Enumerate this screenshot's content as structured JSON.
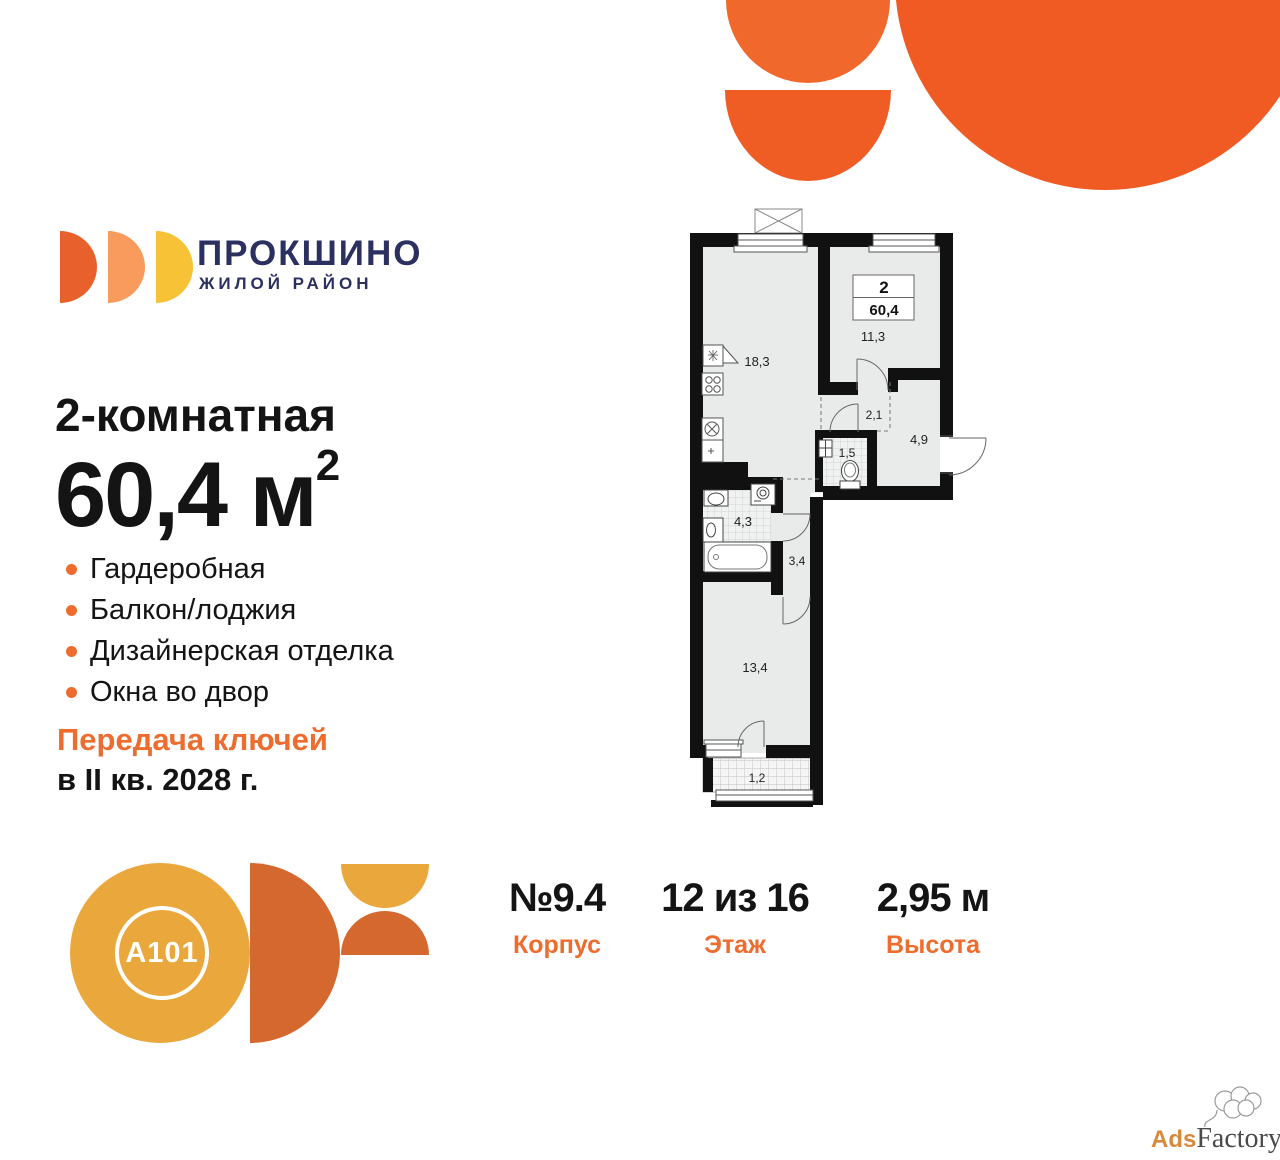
{
  "colors": {
    "accent_orange": "#ED6C2E",
    "brand_navy": "#2B3060",
    "deco_orange_big": "#F05A23",
    "deco_orange_mid": "#EF5D24",
    "deco_orange_light": "#F0682B",
    "logo_half_1": "#E8602C",
    "logo_half_2": "#F89B5C",
    "logo_half_3": "#F8C237",
    "a101_yellow": "#EAA73C",
    "a101_orange": "#D4682F",
    "plan_room_fill": "#E9EBEA",
    "plan_wall": "#111111"
  },
  "brand": {
    "name": "ПРОКШИНО",
    "subtitle": "ЖИЛОЙ РАЙОН"
  },
  "developer": {
    "logo_text": "A101"
  },
  "offer": {
    "title": "2-комнатная",
    "area_value": "60,4",
    "area_unit": " м",
    "area_sup": "2",
    "features": [
      "Гардеробная",
      "Балкон/лоджия",
      "Дизайнерская отделка",
      "Окна во двор"
    ],
    "keys_line1": "Передача ключей",
    "keys_line2": "в II кв. 2028 г."
  },
  "floorplan": {
    "info_box": {
      "rooms": "2",
      "area": "60,4"
    },
    "areas": {
      "kitchen_living": "18,3",
      "bedroom": "11,3",
      "wardrobe": "2,1",
      "hallway": "4,9",
      "wc": "1,5",
      "bathroom": "4,3",
      "corridor": "3,4",
      "bedroom2": "13,4",
      "balcony": "1,2"
    }
  },
  "stats": [
    {
      "value": "№9.4",
      "label": "Корпус"
    },
    {
      "value": "12 из 16",
      "label": "Этаж"
    },
    {
      "value": "2,95 м",
      "label": "Высота"
    }
  ],
  "watermark": {
    "part1": "Ads",
    "part2": "Factory"
  }
}
